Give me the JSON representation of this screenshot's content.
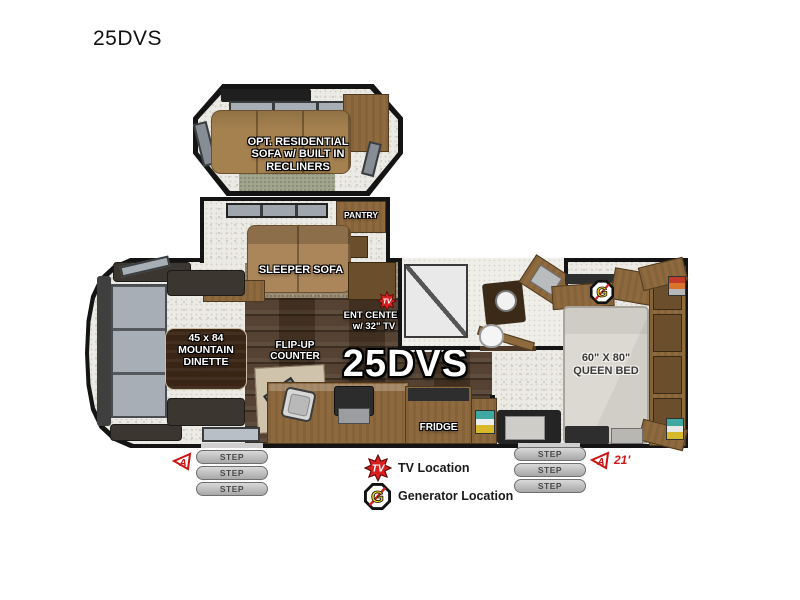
{
  "page": {
    "title": "25DVS"
  },
  "plan": {
    "model": "25DVS",
    "opt_slide_label": "OPT. RESIDENTIAL\nSOFA w/ BUILT IN\nRECLINERS",
    "sleeper_sofa": "SLEEPER SOFA",
    "pantry": "PANTRY",
    "dinette": "45 x 84\nMOUNTAIN\nDINETTE",
    "flip_up_counter": "FLIP-UP\nCOUNTER",
    "ent_center": "ENT CENTER\nw/ 32\" TV",
    "fridge": "FRIDGE",
    "queen_bed": "60\" X 80\"\nQUEEN BED",
    "step": "STEP",
    "awning_length": "21'"
  },
  "icons": {
    "tv": "TV",
    "generator": "G",
    "awning": "A"
  },
  "legend": {
    "tv_label": "TV Location",
    "generator_label": "Generator Location"
  },
  "colors": {
    "accent_red": "#d92020",
    "generator_yellow": "#f2d410",
    "cabinet_wood": "#8f6a3e",
    "floor_wood": "#4c3827"
  }
}
